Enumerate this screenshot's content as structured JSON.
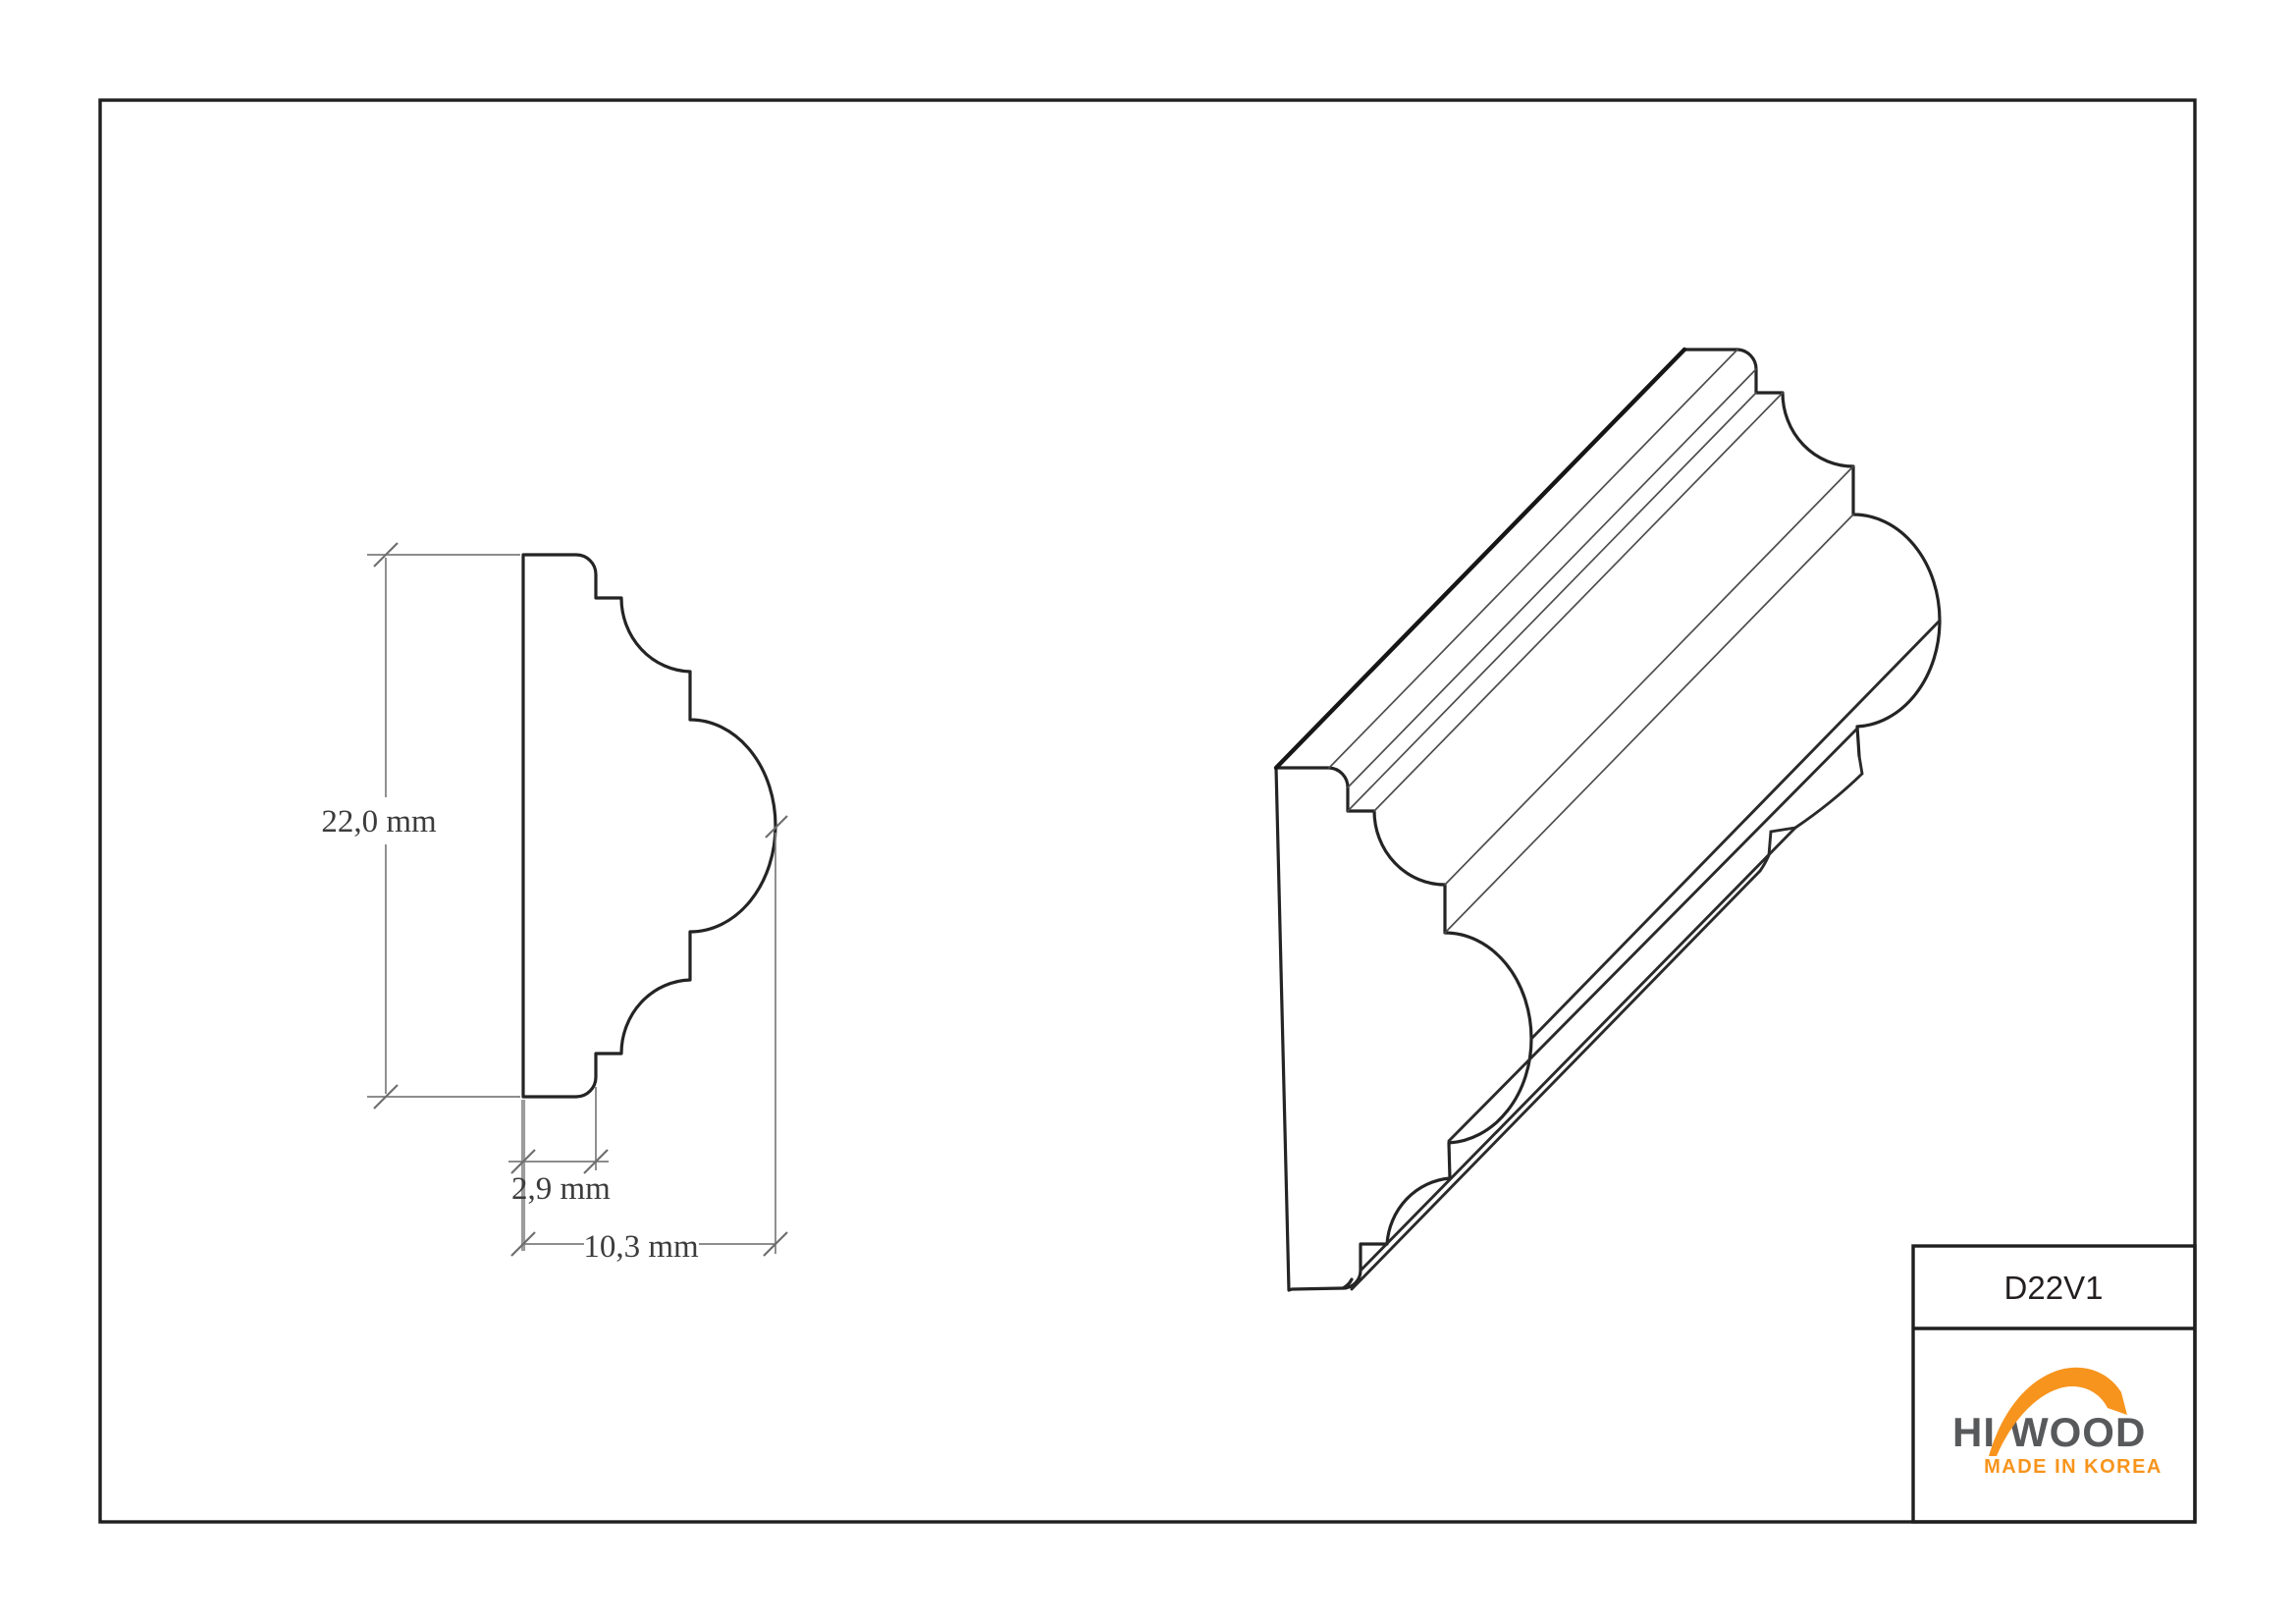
{
  "document": {
    "type": "technical-drawing",
    "background": "#ffffff",
    "border_color": "#1f1f1f"
  },
  "dimensions": {
    "height": "22,0 mm",
    "thickness": "2,9 mm",
    "depth": "10,3 mm"
  },
  "title_block": {
    "part_number": "D22V1",
    "logo": {
      "word_left": "HI",
      "word_right": "WOOD",
      "tagline": "MADE IN KOREA",
      "text_color": "#58595b",
      "accent_color": "#f7941d"
    }
  },
  "drawing": {
    "views": [
      "profile-cross-section",
      "isometric-3d-view"
    ],
    "line_color": "#242424",
    "dimension_line_color": "#7d7d7d"
  }
}
